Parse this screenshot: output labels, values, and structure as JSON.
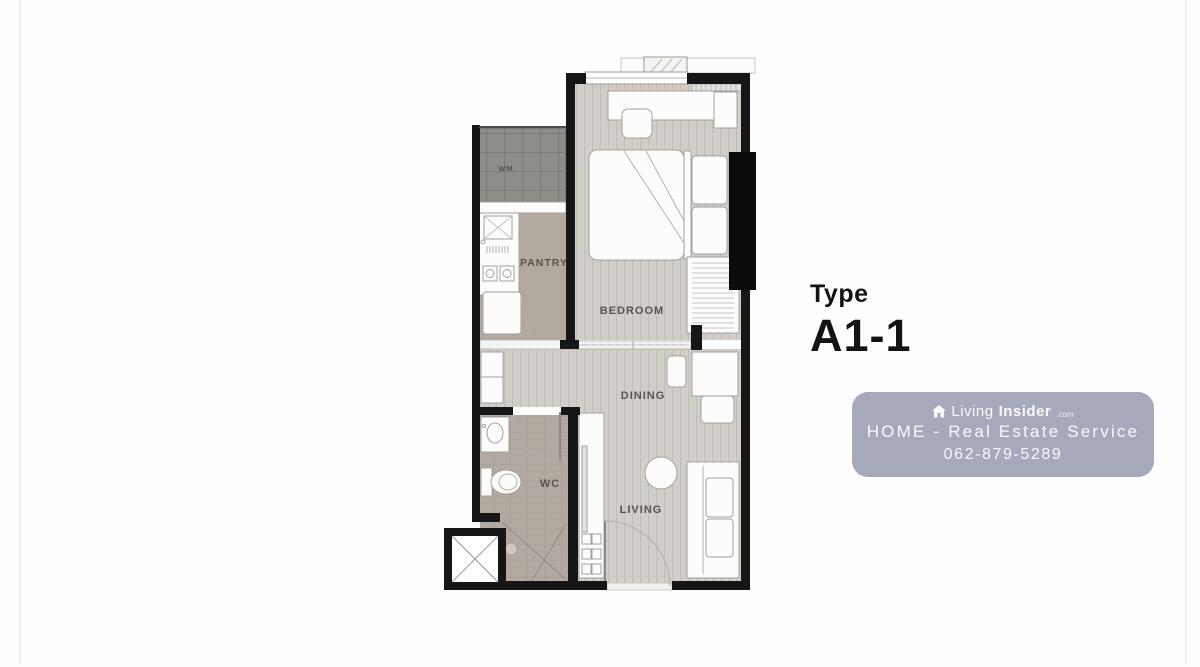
{
  "page": {
    "bg": "#fdfdfd",
    "frame_line_color": "#ededee"
  },
  "floorplan": {
    "rooms": {
      "wm": "WM",
      "pantry": "PANTRY",
      "bedroom": "BEDROOM",
      "dining": "DINING",
      "wc": "WC",
      "living": "LIVING"
    },
    "colors": {
      "wall": "#161616",
      "balcony_door_panel": "#0b0b0b",
      "wood_floor": "#d1cec9",
      "pantry_floor": "#b1a9a0",
      "wc_floor": "#b2aaa2",
      "wm_floor": "#8f8d88",
      "furniture_fill": "#fcfcfb",
      "furniture_stroke": "#a3a19c"
    }
  },
  "unit": {
    "label": "Type",
    "code": "A1-1"
  },
  "watermark": {
    "brand_first": "Living",
    "brand_second": "Insider",
    "brand_tld": ".com",
    "service_line": "HOME - Real Estate Service",
    "phone": "062-879-5289",
    "bg_color": "#a6a9bb",
    "icon": "house-icon"
  }
}
